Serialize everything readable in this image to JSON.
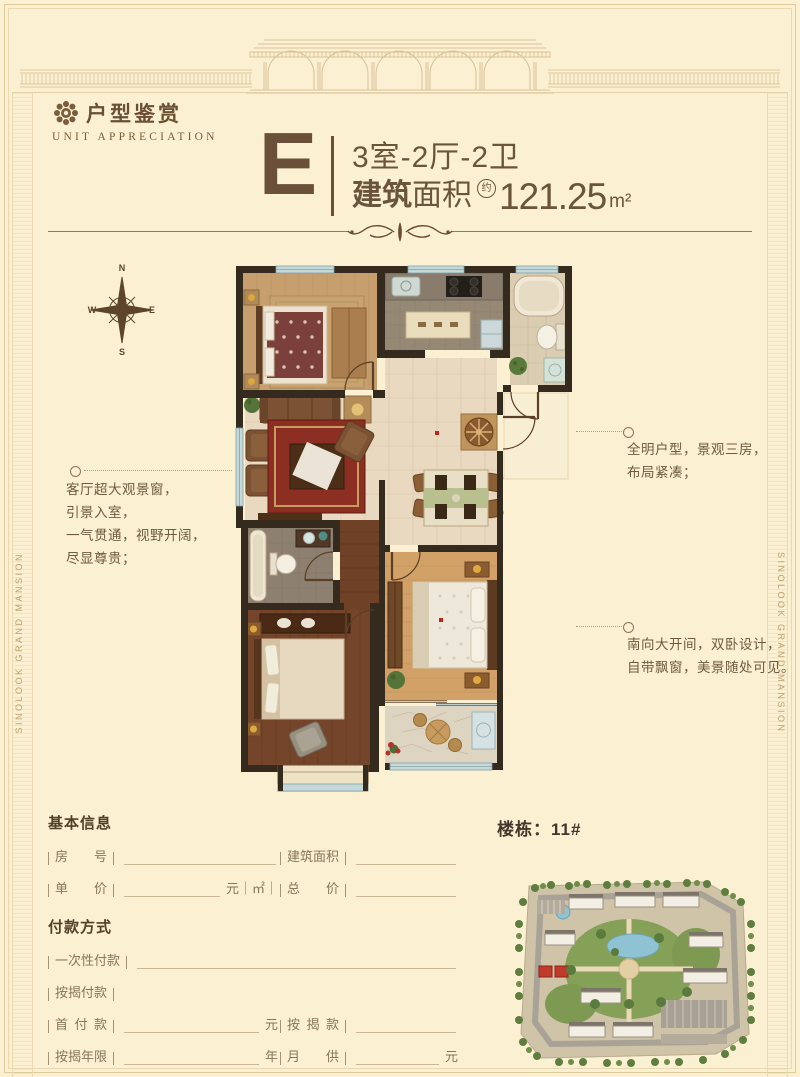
{
  "brand": {
    "title_cn": "户型鉴赏",
    "title_en": "UNIT APPRECIATION"
  },
  "side_text": "SINOLOOK GRAND MANSION",
  "unit": {
    "letter": "E",
    "rooms": "3室-2厅-2卫",
    "area_label_bold": "建筑",
    "area_label_light": "面积",
    "approx": "约",
    "area_value": "121.25",
    "area_unit": "m²"
  },
  "compass": {
    "n": "N",
    "e": "E",
    "s": "S",
    "w": "W"
  },
  "notes": {
    "left": [
      "客厅超大观景窗，",
      "引景入室，",
      "一气贯通，视野开阔，",
      "尽显尊贵；"
    ],
    "right_top": [
      "全明户型，景观三房，",
      "布局紧凑；"
    ],
    "right_bottom": [
      "南向大开间，双卧设计，",
      "自带飘窗，美景随处可见。"
    ]
  },
  "building_label": "楼栋：11#",
  "form": {
    "basic_title": "基本信息",
    "payment_title": "付款方式",
    "room_no": "房号",
    "build_area": "建筑面积",
    "unit_price": "单价",
    "unit_price_suffix": "元｜㎡｜",
    "total_price": "总价",
    "one_time": "一次性付款",
    "mortgage_pay": "按揭付款",
    "down_payment": "首付款",
    "down_suffix": "元",
    "mortgage_amount": "按揭款",
    "mortgage_years": "按揭年限",
    "years_suffix": "年",
    "monthly_pay": "月供",
    "monthly_suffix": "元",
    "remark": "备注",
    "remark_suffix": "元"
  }
}
